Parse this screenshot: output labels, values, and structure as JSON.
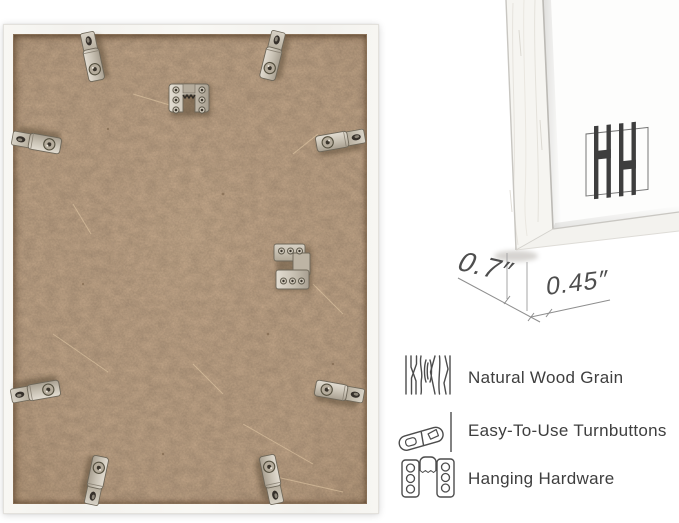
{
  "dimensions": {
    "depth": "0.7″",
    "face_width": "0.45″"
  },
  "features": [
    {
      "icon": "wood-grain-icon",
      "label": "Natural Wood Grain"
    },
    {
      "icon": "turnbutton-icon",
      "label": "Easy-To-Use Turnbuttons"
    },
    {
      "icon": "hanging-hardware-icon",
      "label": "Hanging Hardware"
    }
  ],
  "hardware": {
    "turnbutton_count": 8,
    "sawtooth_hanger": "top center",
    "offset_bracket": "middle right"
  },
  "colors": {
    "background": "#ffffff",
    "kraft_back": "#c7aa8c",
    "frame_white": "#f7f6f2",
    "metal": "#cdc6b9",
    "logo": "#3e3e3e",
    "dimension_line": "#8e8e8e",
    "text": "#3e3e3e"
  }
}
